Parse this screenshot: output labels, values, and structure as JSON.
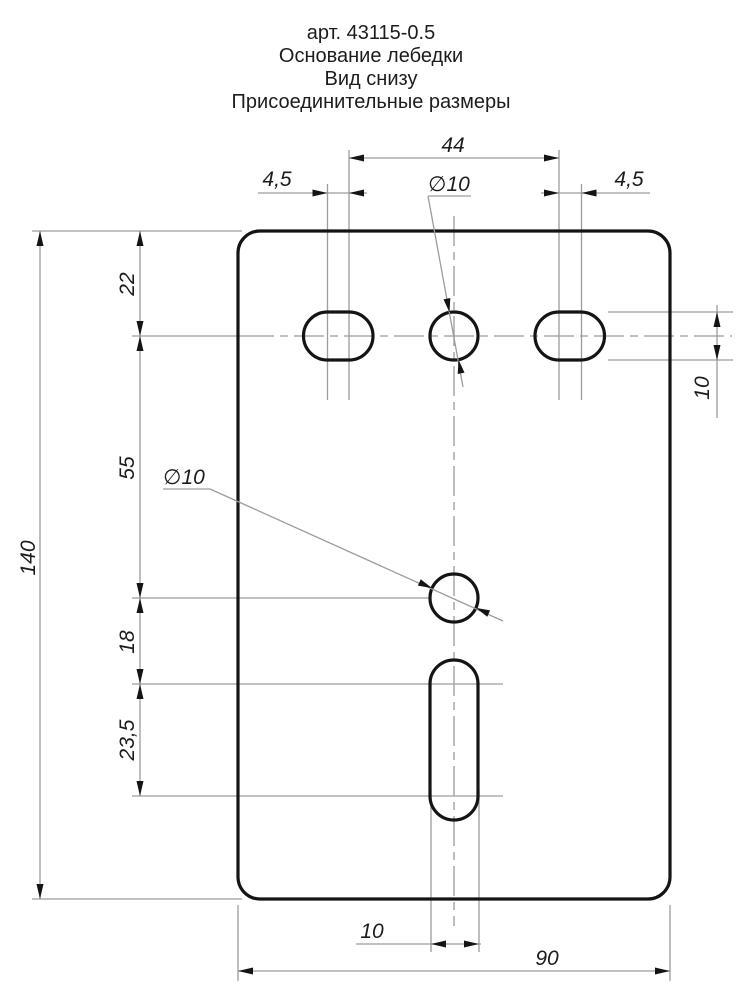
{
  "title": {
    "art": "арт. 43115-0.5",
    "name": "Основание лебедки",
    "view": "Вид снизу",
    "subtitle": "Присоединительные размеры"
  },
  "dims": {
    "overall_height": "140",
    "overall_width": "90",
    "top_edge_to_hole_row": "22",
    "hole_row_to_center_hole": "55",
    "center_hole_to_slot": "18",
    "bottom_slot_arc_span": "23,5",
    "top_holes_span": "44",
    "slot_offset_left": "4,5",
    "slot_offset_right": "4,5",
    "top_hole_diameter": "∅10",
    "center_hole_diameter": "∅10",
    "right_slot_width": "10",
    "bottom_slot_width": "10"
  },
  "colors": {
    "background": "#ffffff",
    "main_line": "#141414",
    "thin_line": "#9c9c9c",
    "text": "#1c1c1c"
  }
}
